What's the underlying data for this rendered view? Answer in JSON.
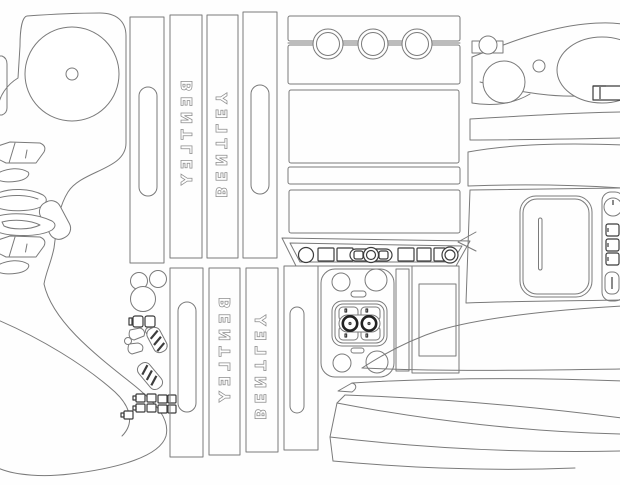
{
  "diagram": {
    "kind": "vehicle dash trim cutting pattern",
    "colors": {
      "background": "#fefefe",
      "line": "#7a7a7a",
      "dark_line": "#3c3c3c"
    },
    "strips": {
      "top_text_strip_left": {
        "label": "BENTLEY"
      },
      "top_text_strip_right": {
        "label": "BENTLEY"
      },
      "bottom_text_strip_left": {
        "label": "BENTLEY"
      },
      "bottom_text_strip_right": {
        "label": "BENTLEY"
      }
    }
  }
}
